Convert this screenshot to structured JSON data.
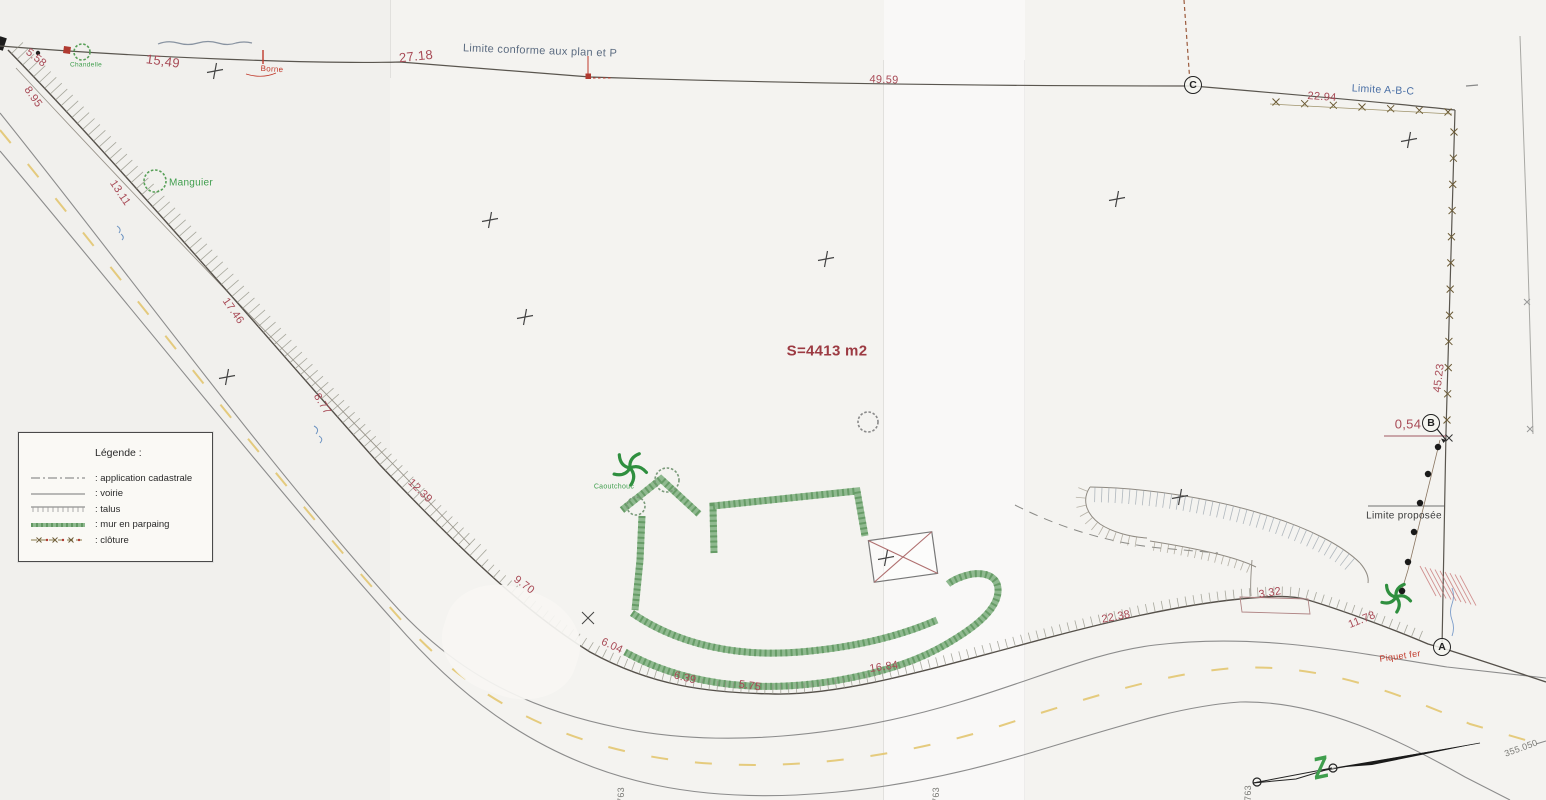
{
  "legend": {
    "title": "Légende :",
    "items": [
      {
        "key": "cadastrale",
        "label": ": application cadastrale"
      },
      {
        "key": "voirie",
        "label": ": voirie"
      },
      {
        "key": "talus",
        "label": ": talus"
      },
      {
        "key": "mur",
        "label": ": mur en parpaing"
      },
      {
        "key": "cloture",
        "label": ": clôture"
      }
    ]
  },
  "area_label": "S=4413 m2",
  "points": [
    {
      "id": "A",
      "x": 1442,
      "y": 647
    },
    {
      "id": "B",
      "x": 1431,
      "y": 423
    },
    {
      "id": "C",
      "x": 1193,
      "y": 85
    }
  ],
  "annotations": [
    {
      "name": "measure-5-58",
      "text": "5.58",
      "x": 36,
      "y": 58,
      "rot": 38,
      "cls": "c-red",
      "size": 11
    },
    {
      "name": "measure-8-95",
      "text": "8.95",
      "x": 33,
      "y": 97,
      "rot": 55,
      "cls": "c-red",
      "size": 11
    },
    {
      "name": "measure-15-49",
      "text": "15,49",
      "x": 163,
      "y": 61,
      "rot": 8,
      "cls": "c-red",
      "size": 13
    },
    {
      "name": "measure-13-11",
      "text": "13.11",
      "x": 120,
      "y": 193,
      "rot": 56,
      "cls": "c-red",
      "size": 11
    },
    {
      "name": "measure-17-46",
      "text": "17.46",
      "x": 233,
      "y": 311,
      "rot": 55,
      "cls": "c-red",
      "size": 11
    },
    {
      "name": "measure-8-77",
      "text": "8.77",
      "x": 322,
      "y": 404,
      "rot": 58,
      "cls": "c-red",
      "size": 11
    },
    {
      "name": "measure-12-39",
      "text": "12.39",
      "x": 420,
      "y": 491,
      "rot": 44,
      "cls": "c-red",
      "size": 11
    },
    {
      "name": "measure-9-70",
      "text": "9.70",
      "x": 524,
      "y": 585,
      "rot": 37,
      "cls": "c-red",
      "size": 11
    },
    {
      "name": "measure-6-04",
      "text": "6.04",
      "x": 612,
      "y": 646,
      "rot": 25,
      "cls": "c-red",
      "size": 11
    },
    {
      "name": "measure-6-39",
      "text": "6.39",
      "x": 685,
      "y": 678,
      "rot": 14,
      "cls": "c-red",
      "size": 11
    },
    {
      "name": "measure-5-75",
      "text": "5.75",
      "x": 750,
      "y": 686,
      "rot": 8,
      "cls": "c-red",
      "size": 11
    },
    {
      "name": "measure-16-84",
      "text": "16.84",
      "x": 884,
      "y": 667,
      "rot": -8,
      "cls": "c-red",
      "size": 11
    },
    {
      "name": "measure-22-38",
      "text": "22.38",
      "x": 1116,
      "y": 617,
      "rot": -11,
      "cls": "c-red",
      "size": 11
    },
    {
      "name": "measure-3-32",
      "text": "3.32",
      "x": 1270,
      "y": 593,
      "rot": -10,
      "cls": "c-red",
      "size": 11
    },
    {
      "name": "measure-11-78",
      "text": "11.78",
      "x": 1362,
      "y": 620,
      "rot": -22,
      "cls": "c-red",
      "size": 11
    },
    {
      "name": "measure-27-18",
      "text": "27.18",
      "x": 416,
      "y": 56,
      "rot": -6,
      "cls": "c-red",
      "size": 13
    },
    {
      "name": "measure-49-59",
      "text": "49.59",
      "x": 884,
      "y": 80,
      "rot": 2,
      "cls": "c-red",
      "size": 11
    },
    {
      "name": "measure-22-94",
      "text": "22.94",
      "x": 1322,
      "y": 97,
      "rot": 4,
      "cls": "c-red",
      "size": 11
    },
    {
      "name": "measure-45-23",
      "text": "45.23",
      "x": 1439,
      "y": 378,
      "rot": -83,
      "cls": "c-red",
      "size": 11
    },
    {
      "name": "measure-0-54",
      "text": "0,54",
      "x": 1408,
      "y": 424,
      "rot": 0,
      "cls": "c-red",
      "size": 13
    },
    {
      "name": "label-limite-conforme",
      "text": "Limite conforme aux plan et P",
      "x": 540,
      "y": 51,
      "rot": 2,
      "cls": "c-bgray",
      "size": 11
    },
    {
      "name": "label-limite-abc",
      "text": "Limite A-B-C",
      "x": 1383,
      "y": 90,
      "rot": 3,
      "cls": "c-blue",
      "size": 10.5
    },
    {
      "name": "label-limite-proposee",
      "text": "Limite proposée",
      "x": 1404,
      "y": 516,
      "rot": 0,
      "cls": "c-dark",
      "size": 10
    },
    {
      "name": "label-borne",
      "text": "Borne",
      "x": 272,
      "y": 69,
      "rot": 3,
      "cls": "c-red2",
      "size": 8
    },
    {
      "name": "label-manguier",
      "text": "Manguier",
      "x": 191,
      "y": 183,
      "rot": 0,
      "cls": "c-green",
      "size": 10
    },
    {
      "name": "label-chandelle",
      "text": "Chandelle",
      "x": 86,
      "y": 65,
      "rot": 0,
      "cls": "c-green",
      "size": 6.5
    },
    {
      "name": "label-caoutchouc",
      "text": "Caoutchouc",
      "x": 614,
      "y": 487,
      "rot": 0,
      "cls": "c-green",
      "size": 7
    },
    {
      "name": "label-piquet-fer",
      "text": "Piquet fer",
      "x": 1400,
      "y": 656,
      "rot": -8,
      "cls": "c-red2",
      "size": 9
    },
    {
      "name": "area-label",
      "text": "S=4413 m2",
      "x": 827,
      "y": 351,
      "rot": 0,
      "cls": "c-maroon",
      "size": 15
    },
    {
      "name": "label-355-050",
      "text": "355.050",
      "x": 1521,
      "y": 748,
      "rot": -20,
      "cls": "c-gray",
      "size": 9
    },
    {
      "name": "coord-763-a",
      "text": "763",
      "x": 621,
      "y": 795,
      "rot": -90,
      "cls": "c-gray",
      "size": 9
    },
    {
      "name": "coord-763-b",
      "text": "763",
      "x": 936,
      "y": 795,
      "rot": -90,
      "cls": "c-gray",
      "size": 9
    },
    {
      "name": "coord-763-c",
      "text": "763",
      "x": 1248,
      "y": 793,
      "rot": -90,
      "cls": "c-gray",
      "size": 9
    },
    {
      "name": "north-symbol",
      "text": "Z",
      "x": 1321,
      "y": 769,
      "rot": -12,
      "cls": "c-north",
      "size": 24,
      "sy": 1.3
    }
  ],
  "colors": {
    "measurement_red": "#a84a56",
    "bright_red": "#c0392b",
    "green": "#3f9e4d",
    "wall_green": "#8fb98f",
    "blue": "#4a6fa5",
    "blue_gray": "#5b6b80",
    "maroon": "#9c3a42",
    "road_yellow": "#e2c368",
    "paper": "#f4f3f0"
  }
}
